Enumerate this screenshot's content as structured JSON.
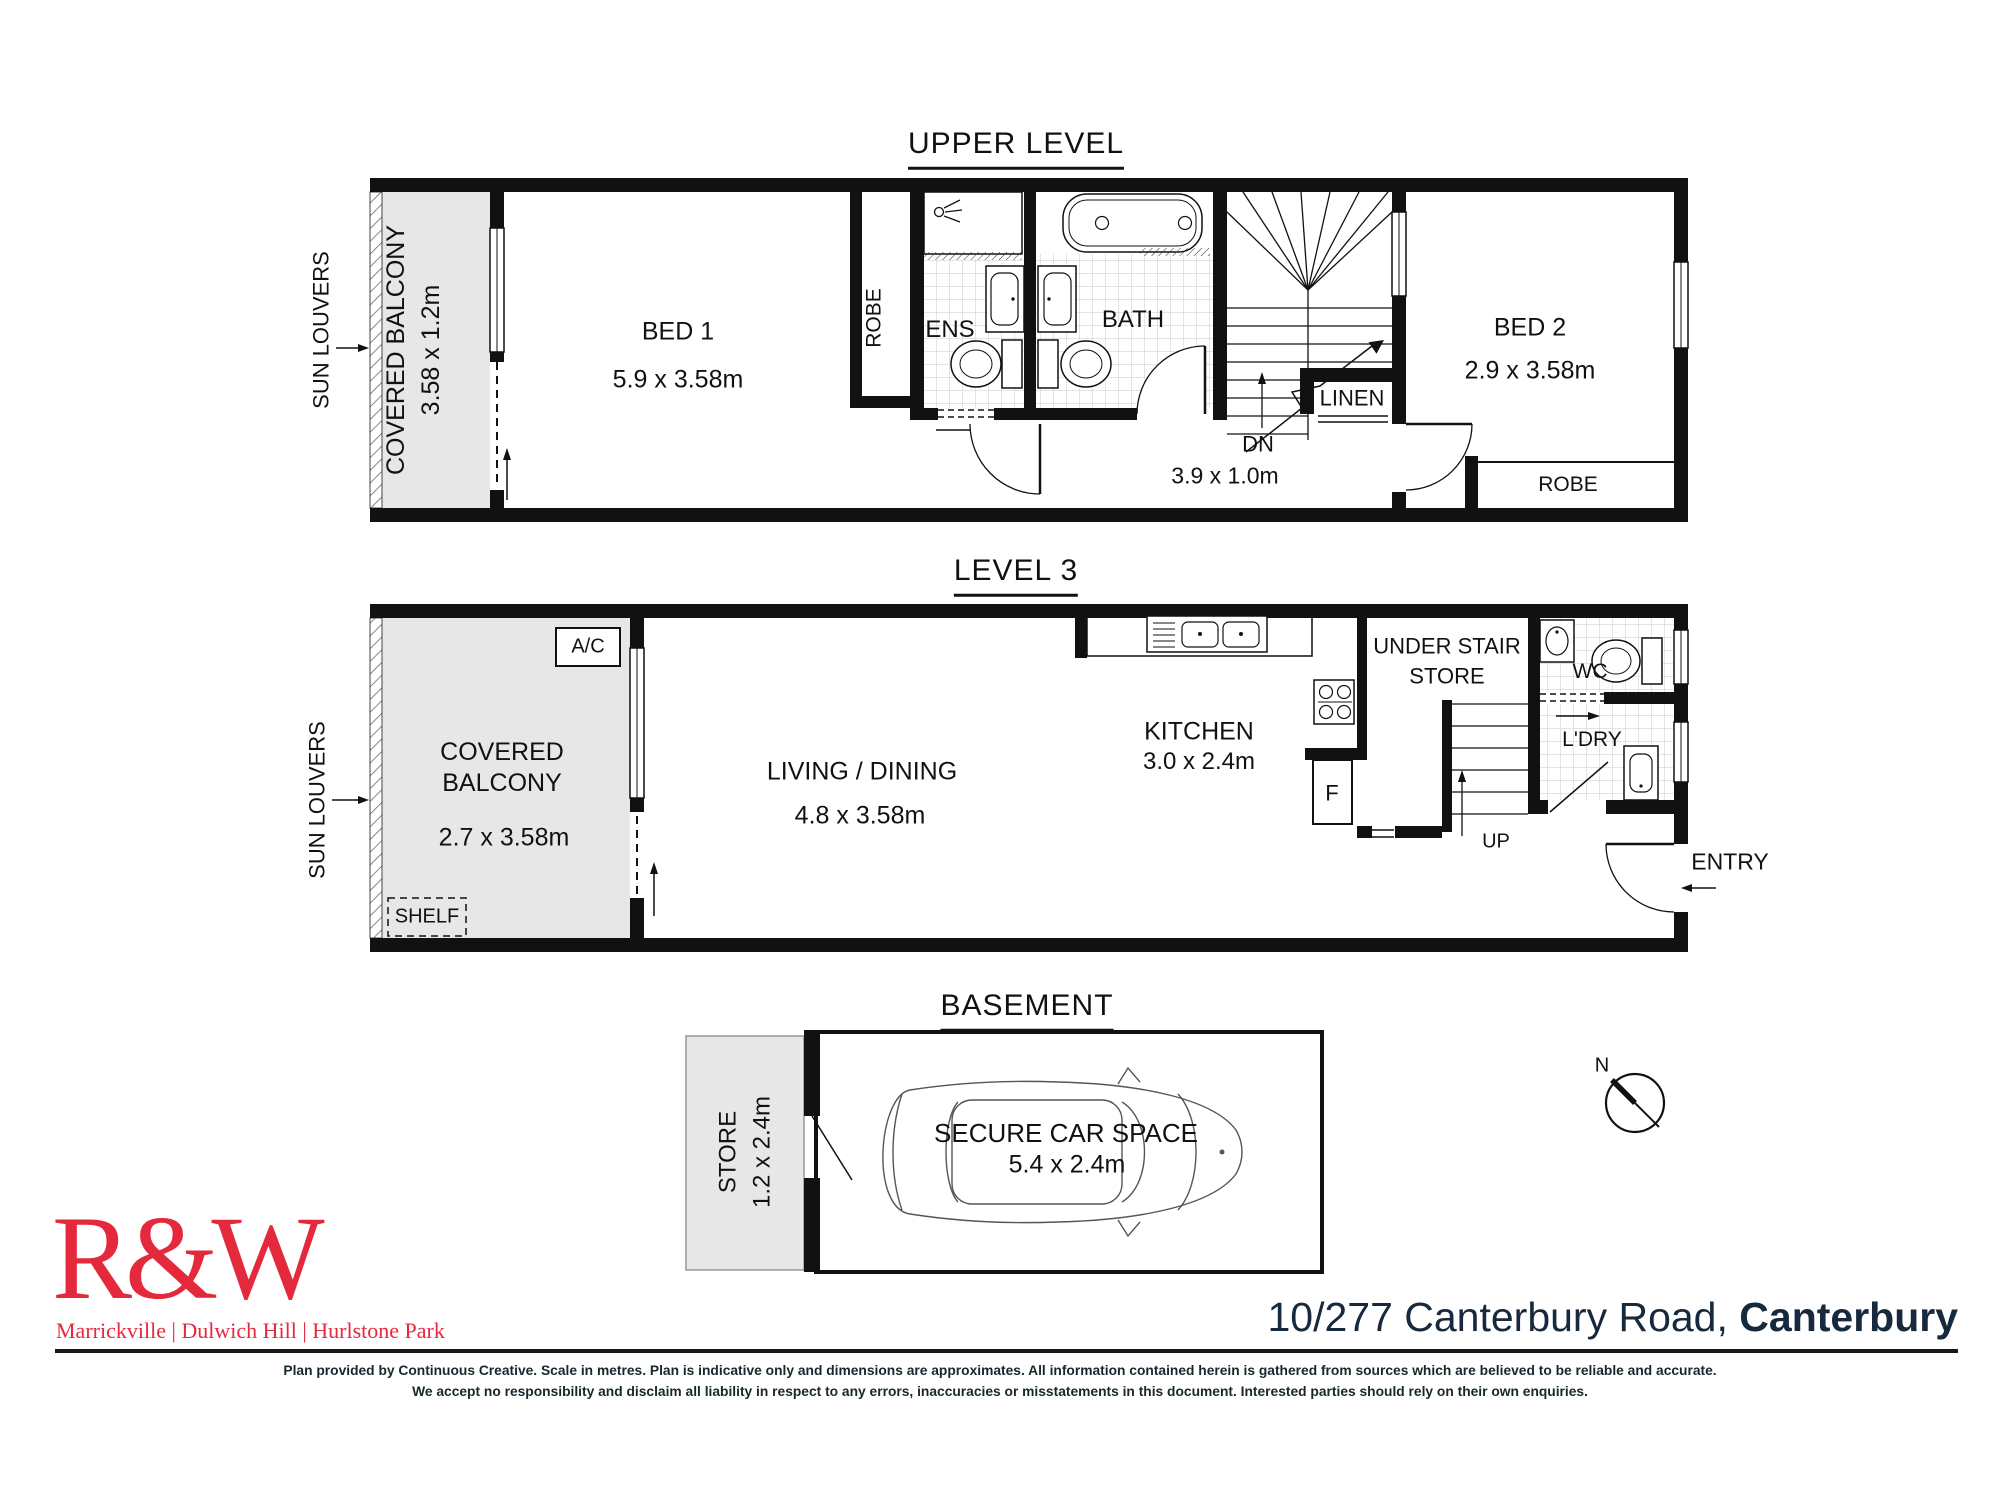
{
  "upper": {
    "title": "UPPER LEVEL",
    "sun_louvers": "SUN LOUVERS",
    "balcony_name": "COVERED BALCONY",
    "balcony_dim": "3.58 x 1.2m",
    "bed1_name": "BED 1",
    "bed1_dim": "5.9 x 3.58m",
    "robe1": "ROBE",
    "ens": "ENS",
    "bath": "BATH",
    "dn": "DN",
    "linen": "LINEN",
    "hall_dim": "3.9 x 1.0m",
    "bed2_name": "BED 2",
    "bed2_dim": "2.9 x 3.58m",
    "robe2": "ROBE"
  },
  "level3": {
    "title": "LEVEL 3",
    "sun_louvers": "SUN LOUVERS",
    "ac": "A/C",
    "balcony_line1": "COVERED",
    "balcony_line2": "BALCONY",
    "balcony_dim": "2.7 x 3.58m",
    "shelf": "SHELF",
    "living_name": "LIVING / DINING",
    "living_dim": "4.8 x 3.58m",
    "kitchen_name": "KITCHEN",
    "kitchen_dim": "3.0 x 2.4m",
    "understair_line1": "UNDER STAIR",
    "understair_line2": "STORE",
    "fridge": "F",
    "up": "UP",
    "wc": "WC",
    "ldry": "L'DRY",
    "entry": "ENTRY"
  },
  "basement": {
    "title": "BASEMENT",
    "store_name": "STORE",
    "store_dim": "1.2 x 2.4m",
    "car_name": "SECURE CAR SPACE",
    "car_dim": "5.4 x 2.4m"
  },
  "compass": {
    "north": "N"
  },
  "footer": {
    "logo": "R&W",
    "tagline": "Marrickville | Dulwich Hill | Hurlstone Park",
    "address_main": "10/277 Canterbury Road, ",
    "address_bold": "Canterbury",
    "disclaimer1": "Plan provided by Continuous Creative. Scale in metres. Plan is indicative only and dimensions are approximates. All information contained herein is gathered from sources which are believed to be reliable and accurate.",
    "disclaimer2": "We accept no responsibility and disclaim all liability in respect to any errors, inaccuracies or misstatements in this document. Interested parties should rely on their own enquiries."
  },
  "colors": {
    "wall": "#111111",
    "area_fill": "#e7e7e7",
    "brand_red": "#e4293d",
    "navy": "#16293d"
  }
}
